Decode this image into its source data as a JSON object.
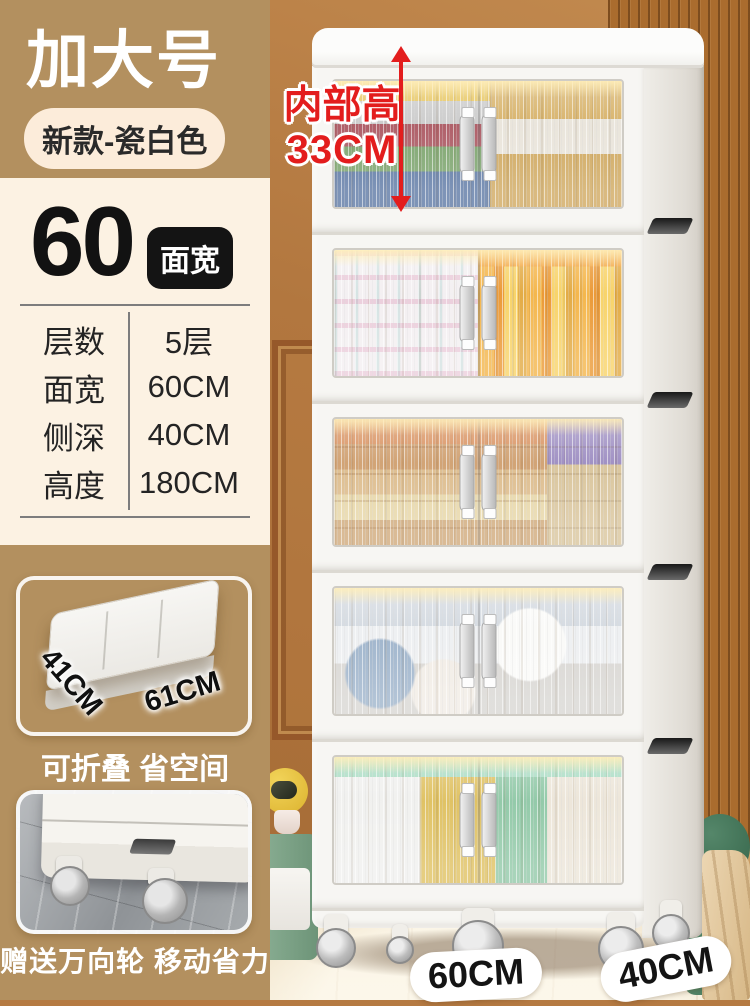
{
  "badges": {
    "size_label": "加大号",
    "variant_label": "新款-瓷白色"
  },
  "spec_panel": {
    "width_number": "60",
    "width_badge": "面宽",
    "rows": [
      {
        "label": "层数",
        "value": "5层"
      },
      {
        "label": "面宽",
        "value": "60CM"
      },
      {
        "label": "侧深",
        "value": "40CM"
      },
      {
        "label": "高度",
        "value": "180CM"
      }
    ]
  },
  "features": [
    {
      "dim_depth": "41CM",
      "dim_width": "61CM",
      "caption": "可折叠 省空间"
    },
    {
      "caption": "赠送万向轮 移动省力"
    }
  ],
  "annotations": {
    "inner_height_title": "内部高",
    "inner_height_value": "33CM",
    "bottom_width": "60CM",
    "bottom_depth": "40CM"
  },
  "colors": {
    "sidebar_tan": "#b3905f",
    "panel_cream": "#fcf2e3",
    "badge_black": "#141414",
    "accent_red": "#e31d1d",
    "cabinet_white": "#f7f6f3",
    "wall_brown": "#b2773f"
  }
}
